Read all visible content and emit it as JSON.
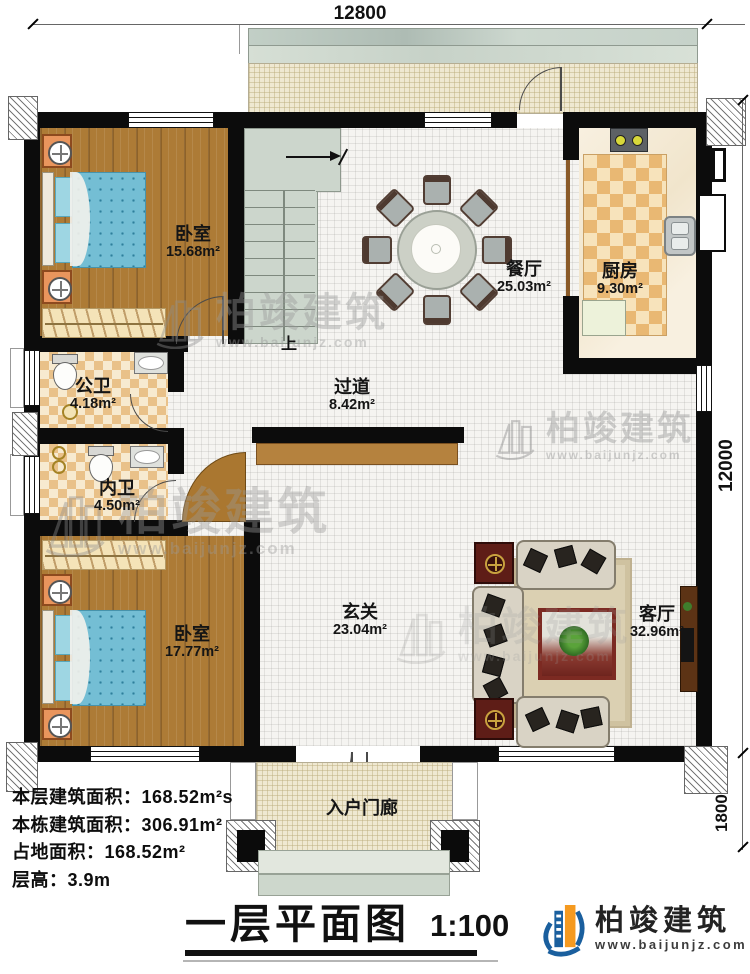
{
  "title_block": {
    "title": "一层平面图",
    "scale": "1:100"
  },
  "dimensions": {
    "top": "12800",
    "right": "12000",
    "porch": "1800"
  },
  "rooms": [
    {
      "name": "卧室",
      "area": "15.68m²"
    },
    {
      "name": "餐厅",
      "area": "25.03m²"
    },
    {
      "name": "厨房",
      "area": "9.30m²"
    },
    {
      "name": "公卫",
      "area": "4.18m²"
    },
    {
      "name": "过道",
      "area": "8.42m²"
    },
    {
      "name": "内卫",
      "area": "4.50m²"
    },
    {
      "name": "卧室",
      "area": "17.77m²"
    },
    {
      "name": "玄关",
      "area": "23.04m²"
    },
    {
      "name": "客厅",
      "area": "32.96m²"
    },
    {
      "name": "入户门廊",
      "area": ""
    }
  ],
  "stairs": {
    "up": "上"
  },
  "info_lines": [
    "本层建筑面积：168.52m²s",
    "本栋建筑面积：306.91m²",
    "占地面积：168.52m²",
    "层高：3.9m"
  ],
  "branding": {
    "company": "柏竣建筑",
    "website": "www.baijunjz.com"
  },
  "watermark": {
    "text": "柏竣建筑",
    "url": "www.baijunjz.com"
  },
  "colors": {
    "wall": "#0c0c0c",
    "wood": "#ad7b36",
    "stair_green": "#ccd6cc",
    "brand_blue": "#1a5f9e",
    "brand_orange": "#f59a20"
  }
}
